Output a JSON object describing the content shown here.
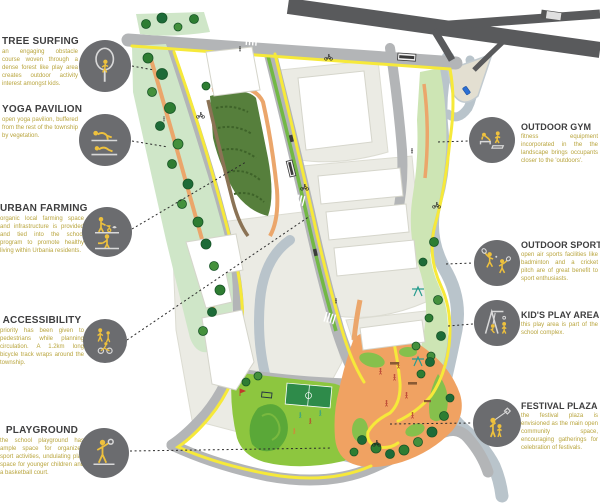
{
  "legend_left": [
    {
      "title": "TREE SURFING",
      "desc": "an engaging obstacle course woven through a dense forest like play area creates outdoor activity interest amongst kids."
    },
    {
      "title": "YOGA PAVILION",
      "desc": "open yoga pavilion, buffered from the rest of the township by vegetation."
    },
    {
      "title": "URBAN FARMING",
      "desc": "organic local farming space and infrastructure is provided and tied into the school program to promote healthy living within Urbania residents."
    },
    {
      "title": "ACCESSIBILITY",
      "desc": "priority has been given to pedestrians while planning circulation. A 1.2km long bicycle track wraps around the township."
    },
    {
      "title": "PLAYGROUND",
      "desc": "the school playground has ample space for organized sport activities, undulating play space for younger children and a basketball court."
    }
  ],
  "legend_right": [
    {
      "title": "OUTDOOR GYM",
      "desc": "fitness equipment incorporated in the the landscape brings occupants closer to the 'outdoors'."
    },
    {
      "title": "OUTDOOR SPORT",
      "desc": "open air sports facilities like badminton and a cricket pitch are of great benefit to sport enthusiasts."
    },
    {
      "title": "KID'S PLAY AREA",
      "desc": "this play area is part of the school complex."
    },
    {
      "title": "FESTIVAL PLAZA",
      "desc": "the festival plaza is envisioned as the main open community space, encouraging gatherings for celebration of festivals."
    }
  ],
  "colors": {
    "icon_circle": "#6b6c6f",
    "icon_yellow": "#eec13d",
    "heading": "#3e3e3f",
    "description": "#b9a53e",
    "bike_path_yellow": "#f6e93a",
    "plaza_orange": "#f0a262",
    "park_green": "#8dc63f",
    "water": "#b9c4cb",
    "road": "#b3b5b7",
    "highway": "#595a5c"
  }
}
